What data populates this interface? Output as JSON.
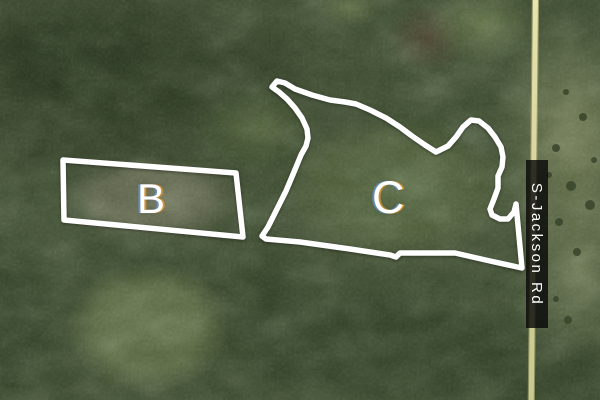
{
  "map": {
    "parcels": {
      "b": {
        "label": "B",
        "points": "63,160 236,173 243,237 64,220"
      },
      "c": {
        "label": "C",
        "points": "272,87 277,81 285,83 295,89 312,95 330,100 345,102 356,104 370,110 386,118 400,127 412,136 425,145 436,152 448,146 456,137 463,127 471,120 479,121 488,128 495,137 501,147 503,157 502,167 498,176 498,188 494,199 490,209 492,215 500,219 508,219 514,212 516,204 522,268 490,261 455,253 400,253 396,257 390,255 350,249 300,242 266,239 262,236 268,227 276,211 286,191 294,172 301,155 306,146 308,138 307,129 302,118 295,108 287,99 279,92"
      }
    },
    "road": {
      "name": "S-Jackson Rd",
      "orientation": "vertical"
    },
    "colors": {
      "parcel_outline": "#ffffff",
      "road_fill": "#d9d6a0",
      "road_label_bg": "#0a0a0a",
      "road_label_text": "#ffffff",
      "forest_dark": "#2e3c26",
      "field_b": "#5e6449",
      "field_c": "#475834",
      "field_east_of_road": "#6d7750"
    }
  }
}
